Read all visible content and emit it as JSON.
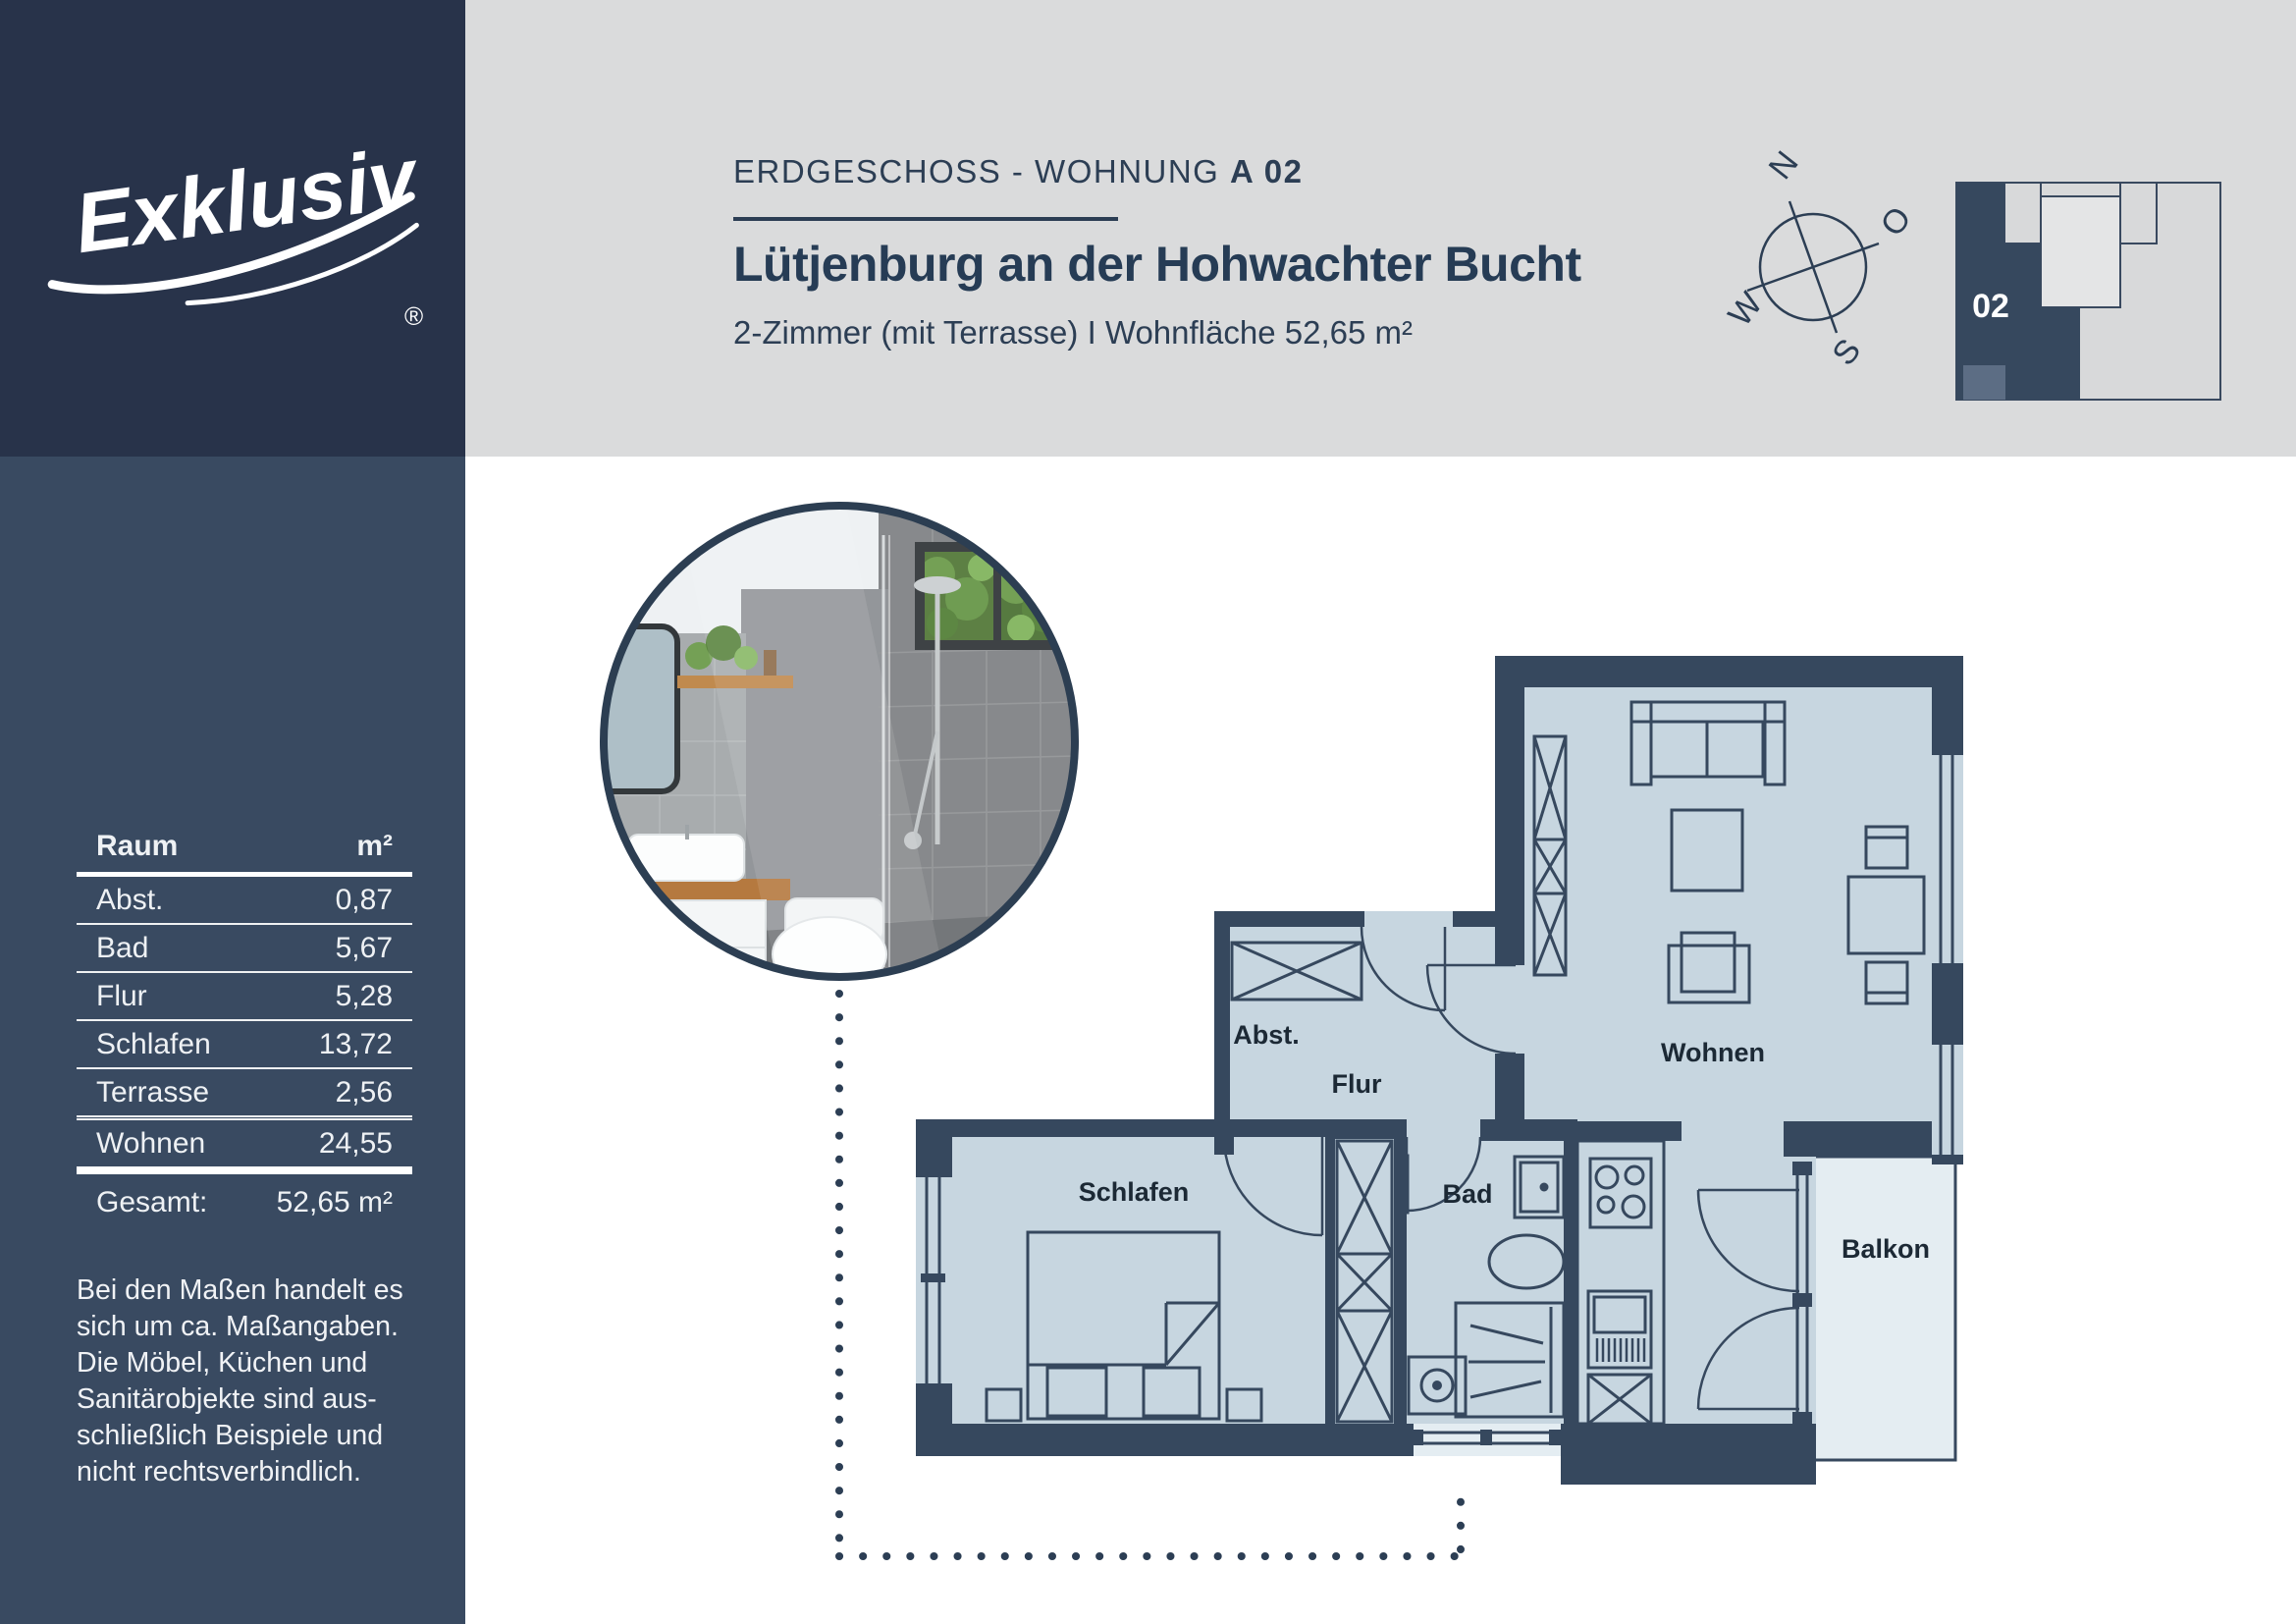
{
  "brand": {
    "logo_text": "Exklusiv",
    "registered_mark": "®"
  },
  "header": {
    "kicker_regular": "ERDGESCHOSS - WOHNUNG ",
    "kicker_bold": "A 02",
    "title": "Lütjenburg an der Hohwachter Bucht",
    "subtitle": "2-Zimmer (mit Terrasse)  I  Wohnfläche 52,65 m²"
  },
  "compass": {
    "north": "N",
    "east": "O",
    "south": "S",
    "west": "W"
  },
  "minimap": {
    "unit_label": "02"
  },
  "sidebar": {
    "table": {
      "header": {
        "room": "Raum",
        "area": "m²"
      },
      "rows": [
        {
          "room": "Abst.",
          "area": "0,87"
        },
        {
          "room": "Bad",
          "area": "5,67"
        },
        {
          "room": "Flur",
          "area": "5,28"
        },
        {
          "room": "Schlafen",
          "area": "13,72"
        },
        {
          "room": "Terrasse",
          "area": "2,56"
        },
        {
          "room": "Wohnen",
          "area": "24,55"
        }
      ],
      "total": {
        "label": "Gesamt:",
        "value": "52,65 m²"
      }
    },
    "disclaimer": "Bei den Maßen handelt es\nsich um ca. Maßangaben.\nDie Möbel, Küchen und\nSanitärobjekte sind aus-\nschließlich Beispiele und\nnicht rechtsverbindlich."
  },
  "plan": {
    "labels": {
      "abst": "Abst.",
      "flur": "Flur",
      "bad": "Bad",
      "schlafen": "Schlafen",
      "wohnen": "Wohnen",
      "balkon": "Balkon"
    }
  },
  "colors": {
    "navy_dark": "#28334a",
    "navy_sidebar": "#394a61",
    "navy_text": "#2c3e54",
    "wall": "#36485e",
    "room_fill": "#c7d6e0",
    "balcony_fill": "#e4edf2",
    "header_band": "#dadbdc"
  }
}
